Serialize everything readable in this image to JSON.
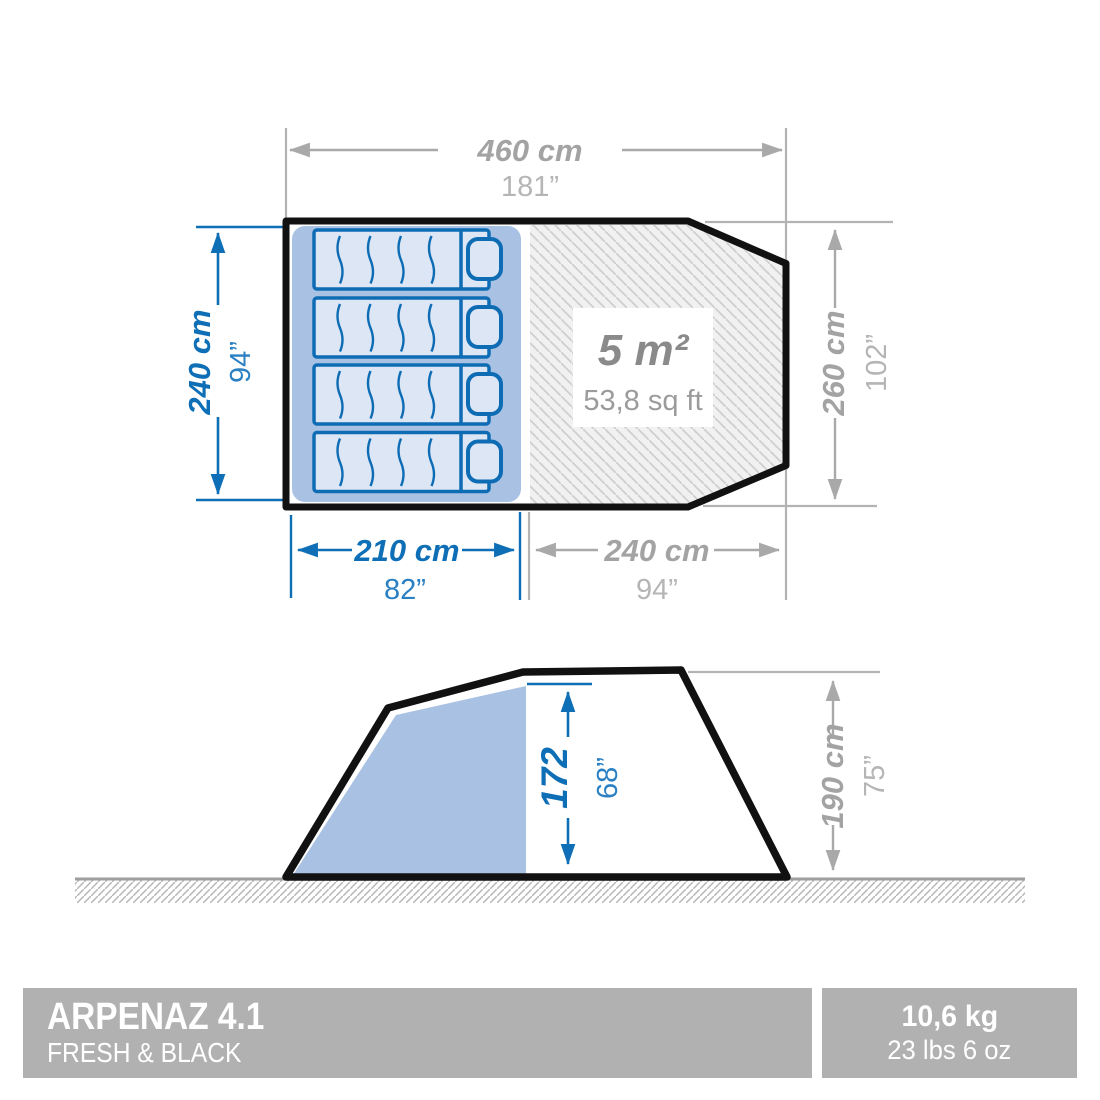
{
  "product_bar": {
    "model": "ARPENAZ 4.1",
    "series": "FRESH & BLACK",
    "weight_metric": "10,6 kg",
    "weight_imperial": "23 lbs 6 oz"
  },
  "top_view": {
    "total_width": {
      "cm": "460 cm",
      "inch": "181”"
    },
    "sleeping_depth": {
      "cm": "240 cm",
      "inch": "94”"
    },
    "total_depth": {
      "cm": "260 cm",
      "inch": "102”"
    },
    "sleeping_width": {
      "cm": "210 cm",
      "inch": "82”"
    },
    "living_width": {
      "cm": "240 cm",
      "inch": "94”"
    },
    "living_area": {
      "metric": "5 m²",
      "imperial": "53,8 sq ft"
    }
  },
  "side_view": {
    "interior_height": {
      "cm": "172",
      "inch": "68”"
    },
    "total_height": {
      "cm": "190 cm",
      "inch": "75”"
    }
  },
  "colors": {
    "dimension_blue": "#0e6fb6",
    "dimension_gray": "#a3a3a3",
    "cabin_blue": "#a9c2e3",
    "pad_fill": "#dce6f5",
    "pad_line_blue": "#0e6cb4",
    "outline_black": "#111111",
    "badge_gray": "#b1b1b1"
  }
}
